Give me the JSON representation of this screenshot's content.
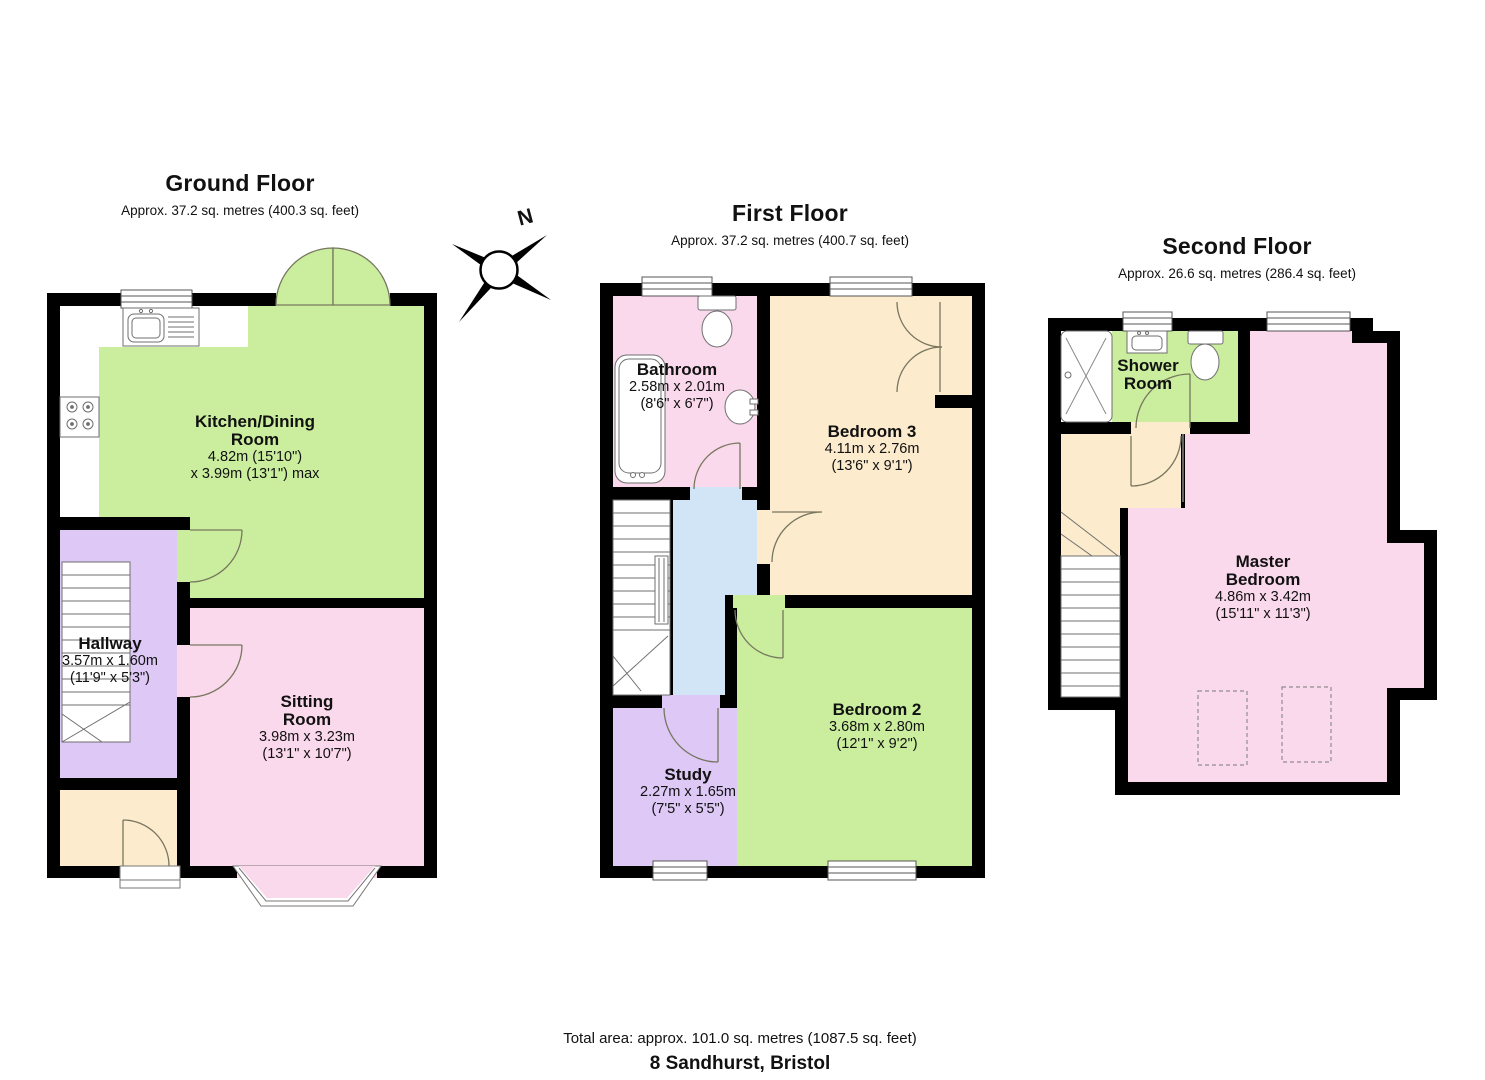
{
  "floors": {
    "ground": {
      "title": "Ground Floor",
      "subtitle": "Approx. 37.2 sq. metres (400.3 sq. feet)",
      "rooms": {
        "kitchen": {
          "name": "Kitchen/Dining\nRoom",
          "dims": "4.82m (15'10\")\nx 3.99m (13'1\") max"
        },
        "hallway": {
          "name": "Hallway",
          "dims": "3.57m x 1.60m\n(11'9\" x 5'3\")"
        },
        "sitting": {
          "name": "Sitting\nRoom",
          "dims": "3.98m x 3.23m\n(13'1\" x 10'7\")"
        }
      }
    },
    "first": {
      "title": "First Floor",
      "subtitle": "Approx. 37.2 sq. metres (400.7 sq. feet)",
      "rooms": {
        "bathroom": {
          "name": "Bathroom",
          "dims": "2.58m x 2.01m\n(8'6\" x 6'7\")"
        },
        "bedroom3": {
          "name": "Bedroom 3",
          "dims": "4.11m x 2.76m\n(13'6\" x 9'1\")"
        },
        "study": {
          "name": "Study",
          "dims": "2.27m x 1.65m\n(7'5\" x 5'5\")"
        },
        "bedroom2": {
          "name": "Bedroom 2",
          "dims": "3.68m x 2.80m\n(12'1\" x 9'2\")"
        }
      }
    },
    "second": {
      "title": "Second Floor",
      "subtitle": "Approx. 26.6 sq. metres (286.4 sq. feet)",
      "rooms": {
        "shower": {
          "name": "Shower\nRoom"
        },
        "master": {
          "name": "Master\nBedroom",
          "dims": "4.86m x 3.42m\n(15'11\" x 11'3\")"
        }
      }
    }
  },
  "compass": {
    "north_label": "N"
  },
  "footer": {
    "total_area": "Total area: approx. 101.0 sq. metres (1087.5 sq. feet)",
    "address": "8 Sandhurst, Bristol"
  },
  "colors": {
    "green": "#cbee9e",
    "pink": "#fbd9ec",
    "purple": "#ddc8f6",
    "beige": "#fcebcd",
    "blue": "#d2e5f7",
    "wall": "#000000"
  }
}
